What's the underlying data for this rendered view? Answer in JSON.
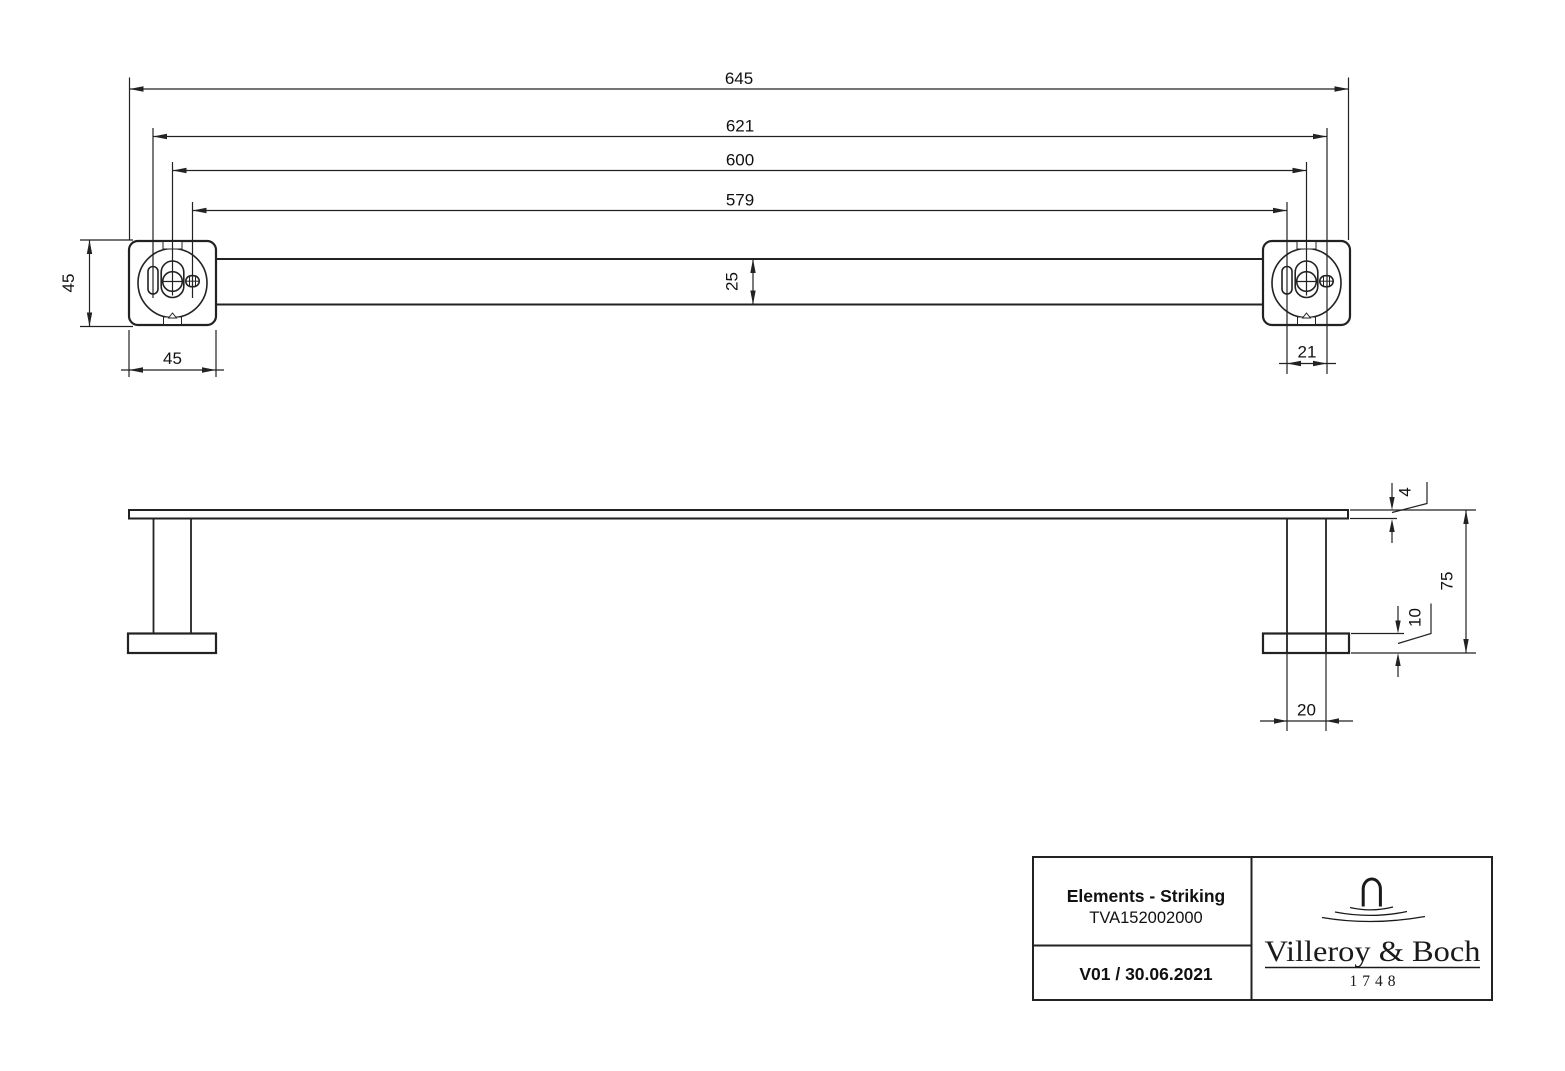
{
  "front_view": {
    "dim_overall_width": "645",
    "dim_left_slot_to_right_screw": "621",
    "dim_mount_centers": "600",
    "dim_left_screw_to_right_slot": "579",
    "dim_bar_height": "25",
    "dim_plate_height": "45",
    "dim_plate_width": "45",
    "dim_slot_to_screw_spacing": "21"
  },
  "side_view": {
    "dim_bar_thickness": "4",
    "dim_wall_offset": "75",
    "dim_plate_thickness": "10",
    "dim_post_width": "20"
  },
  "title_block": {
    "product_line": "Elements - Striking",
    "article_number": "TVA152002000",
    "revision": "V01 / 30.06.2021",
    "brand_name": "Villeroy & Boch",
    "brand_year": "1748"
  },
  "colors": {
    "line": "#222222",
    "text": "#111111",
    "background": "#ffffff"
  }
}
